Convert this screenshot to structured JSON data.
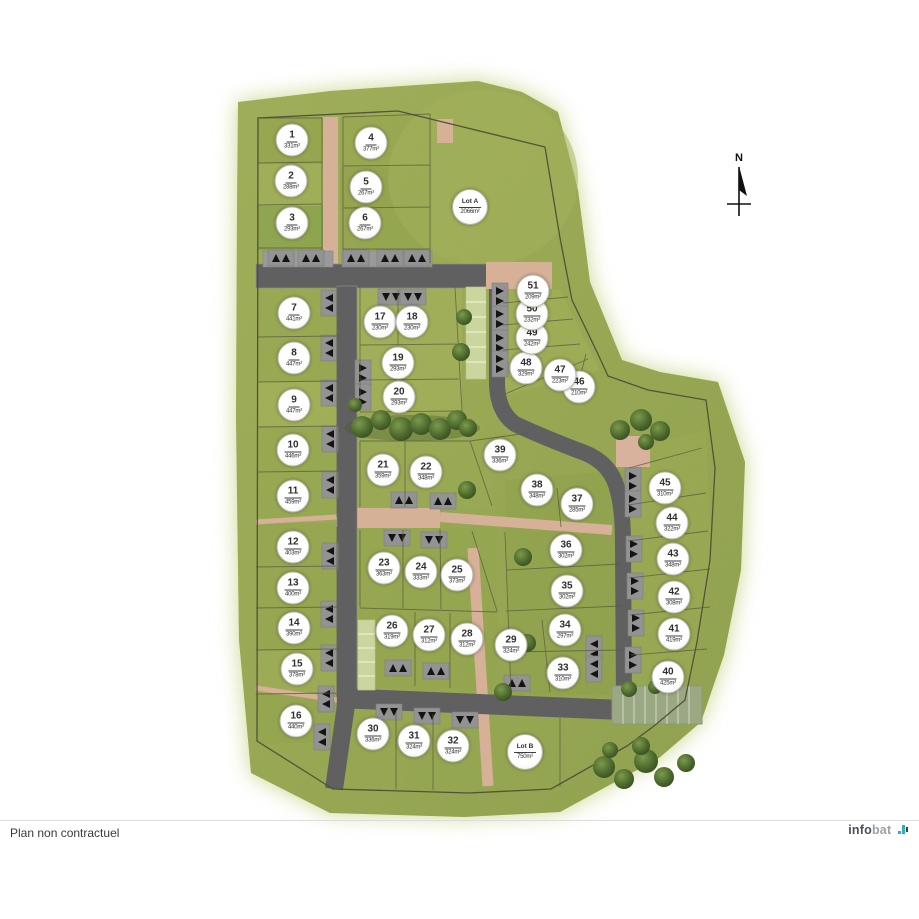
{
  "page": {
    "footer_note": "Plan non contractuel",
    "brand": {
      "name_dark": "info",
      "name_light": "bat"
    }
  },
  "compass": {
    "label": "N"
  },
  "plan": {
    "area_unit": "m²",
    "lots": [
      {
        "id": "1",
        "area": "331",
        "x": 292,
        "y": 140
      },
      {
        "id": "2",
        "area": "288",
        "x": 291,
        "y": 181
      },
      {
        "id": "3",
        "area": "293",
        "x": 292,
        "y": 223
      },
      {
        "id": "4",
        "area": "377",
        "x": 371,
        "y": 143
      },
      {
        "id": "5",
        "area": "267",
        "x": 366,
        "y": 187
      },
      {
        "id": "6",
        "area": "267",
        "x": 365,
        "y": 223
      },
      {
        "id": "Lot A",
        "area": "2066",
        "x": 470,
        "y": 207,
        "special": true
      },
      {
        "id": "7",
        "area": "441",
        "x": 294,
        "y": 313
      },
      {
        "id": "8",
        "area": "447",
        "x": 294,
        "y": 358
      },
      {
        "id": "9",
        "area": "447",
        "x": 294,
        "y": 405
      },
      {
        "id": "10",
        "area": "446",
        "x": 293,
        "y": 450
      },
      {
        "id": "11",
        "area": "459",
        "x": 293,
        "y": 496
      },
      {
        "id": "12",
        "area": "403",
        "x": 293,
        "y": 547
      },
      {
        "id": "13",
        "area": "400",
        "x": 293,
        "y": 588
      },
      {
        "id": "14",
        "area": "390",
        "x": 294,
        "y": 628
      },
      {
        "id": "15",
        "area": "378",
        "x": 297,
        "y": 669
      },
      {
        "id": "16",
        "area": "440",
        "x": 296,
        "y": 721
      },
      {
        "id": "17",
        "area": "230",
        "x": 380,
        "y": 322
      },
      {
        "id": "18",
        "area": "230",
        "x": 412,
        "y": 322
      },
      {
        "id": "19",
        "area": "293",
        "x": 398,
        "y": 363
      },
      {
        "id": "20",
        "area": "293",
        "x": 399,
        "y": 397
      },
      {
        "id": "21",
        "area": "359",
        "x": 383,
        "y": 470
      },
      {
        "id": "22",
        "area": "348",
        "x": 426,
        "y": 472
      },
      {
        "id": "23",
        "area": "363",
        "x": 384,
        "y": 568
      },
      {
        "id": "24",
        "area": "333",
        "x": 421,
        "y": 572
      },
      {
        "id": "25",
        "area": "373",
        "x": 457,
        "y": 575
      },
      {
        "id": "26",
        "area": "319",
        "x": 392,
        "y": 631
      },
      {
        "id": "27",
        "area": "312",
        "x": 429,
        "y": 635
      },
      {
        "id": "28",
        "area": "312",
        "x": 467,
        "y": 639
      },
      {
        "id": "29",
        "area": "324",
        "x": 511,
        "y": 645
      },
      {
        "id": "30",
        "area": "336",
        "x": 373,
        "y": 734
      },
      {
        "id": "31",
        "area": "324",
        "x": 414,
        "y": 741
      },
      {
        "id": "32",
        "area": "324",
        "x": 453,
        "y": 746
      },
      {
        "id": "Lot B",
        "area": "750",
        "x": 525,
        "y": 752,
        "special": true
      },
      {
        "id": "33",
        "area": "310",
        "x": 563,
        "y": 673
      },
      {
        "id": "34",
        "area": "297",
        "x": 565,
        "y": 630
      },
      {
        "id": "35",
        "area": "302",
        "x": 567,
        "y": 591
      },
      {
        "id": "36",
        "area": "302",
        "x": 566,
        "y": 550
      },
      {
        "id": "37",
        "area": "285",
        "x": 577,
        "y": 504
      },
      {
        "id": "38",
        "area": "348",
        "x": 537,
        "y": 490
      },
      {
        "id": "39",
        "area": "336",
        "x": 500,
        "y": 455
      },
      {
        "id": "40",
        "area": "425",
        "x": 668,
        "y": 677
      },
      {
        "id": "41",
        "area": "419",
        "x": 674,
        "y": 634
      },
      {
        "id": "42",
        "area": "308",
        "x": 674,
        "y": 597
      },
      {
        "id": "43",
        "area": "348",
        "x": 673,
        "y": 559
      },
      {
        "id": "44",
        "area": "322",
        "x": 672,
        "y": 523
      },
      {
        "id": "45",
        "area": "310",
        "x": 665,
        "y": 488
      },
      {
        "id": "46",
        "area": "210",
        "x": 579,
        "y": 387
      },
      {
        "id": "47",
        "area": "223",
        "x": 560,
        "y": 375
      },
      {
        "id": "48",
        "area": "329",
        "x": 526,
        "y": 368
      },
      {
        "id": "49",
        "area": "242",
        "x": 532,
        "y": 338
      },
      {
        "id": "50",
        "area": "232",
        "x": 532,
        "y": 314
      },
      {
        "id": "51",
        "area": "209",
        "x": 533,
        "y": 291
      }
    ]
  },
  "colors": {
    "grass": "#9aa750",
    "grass-light": "#cbd78f",
    "road": "#606060",
    "path": "#d7b098",
    "line": "#5a5942",
    "bnd": "#4f4e38",
    "circle-border": "#b2b2a6",
    "ink": "#2e2e2e",
    "brand-dark": "#4b505a",
    "brand-light": "#9aa1a9",
    "brand-teal": "#2fb0bf",
    "sep": "#dcdcdc"
  }
}
